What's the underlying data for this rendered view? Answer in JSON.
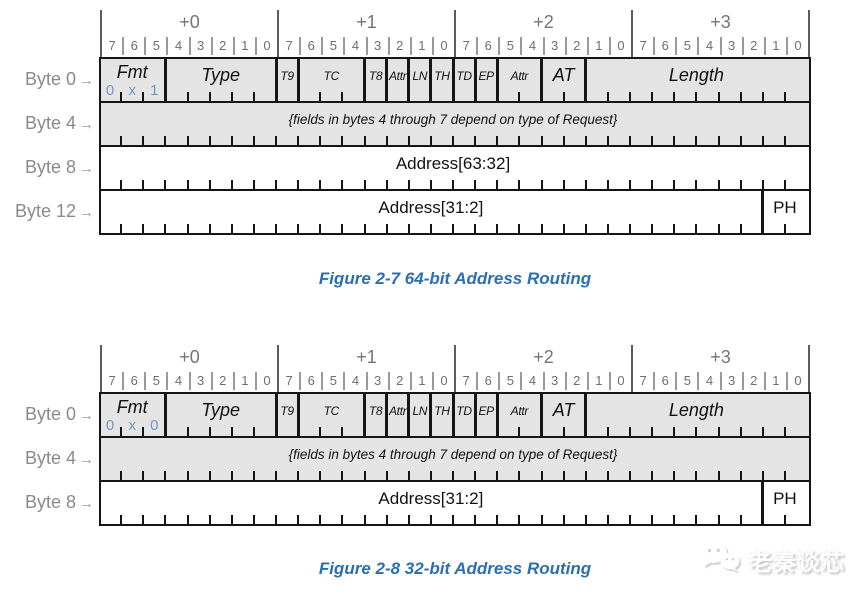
{
  "arrow": "→",
  "offsets": [
    "+0",
    "+1",
    "+2",
    "+3"
  ],
  "bit_numbers": [
    "7",
    "6",
    "5",
    "4",
    "3",
    "2",
    "1",
    "0"
  ],
  "colors": {
    "caption_blue": "#2a6faf",
    "fmt_value_blue": "#7495c6",
    "shaded_row_fill": "#e4e4e4",
    "border_black": "#151515",
    "gray_label": "#8a8a8a"
  },
  "figures": [
    {
      "caption": "Figure 2-7 64-bit Address Routing",
      "rows": [
        {
          "label": "Byte 0",
          "shaded": true,
          "fields": [
            {
              "label": "Fmt",
              "bits": 3,
              "value": "0x1"
            },
            {
              "label": "Type",
              "bits": 5
            },
            {
              "label": "T9",
              "bits": 1
            },
            {
              "label": "TC",
              "bits": 3
            },
            {
              "label": "T8",
              "bits": 1
            },
            {
              "label": "Attr",
              "bits": 1
            },
            {
              "label": "LN",
              "bits": 1
            },
            {
              "label": "TH",
              "bits": 1
            },
            {
              "label": "TD",
              "bits": 1
            },
            {
              "label": "EP",
              "bits": 1
            },
            {
              "label": "Attr",
              "bits": 2
            },
            {
              "label": "AT",
              "bits": 2
            },
            {
              "label": "Length",
              "bits": 10
            }
          ]
        },
        {
          "label": "Byte 4",
          "shaded": true,
          "note": "{fields in bytes 4 through 7 depend on type of Request}",
          "fields": [
            {
              "label": "",
              "bits": 32
            }
          ]
        },
        {
          "label": "Byte 8",
          "shaded": false,
          "fields": [
            {
              "label": "Address[63:32]",
              "bits": 32
            }
          ]
        },
        {
          "label": "Byte 12",
          "shaded": false,
          "fields": [
            {
              "label": "Address[31:2]",
              "bits": 30
            },
            {
              "label": "PH",
              "bits": 2
            }
          ]
        }
      ]
    },
    {
      "caption": "Figure 2-8 32-bit Address Routing",
      "rows": [
        {
          "label": "Byte 0",
          "shaded": true,
          "fields": [
            {
              "label": "Fmt",
              "bits": 3,
              "value": "0x0"
            },
            {
              "label": "Type",
              "bits": 5
            },
            {
              "label": "T9",
              "bits": 1
            },
            {
              "label": "TC",
              "bits": 3
            },
            {
              "label": "T8",
              "bits": 1
            },
            {
              "label": "Attr",
              "bits": 1
            },
            {
              "label": "LN",
              "bits": 1
            },
            {
              "label": "TH",
              "bits": 1
            },
            {
              "label": "TD",
              "bits": 1
            },
            {
              "label": "EP",
              "bits": 1
            },
            {
              "label": "Attr",
              "bits": 2
            },
            {
              "label": "AT",
              "bits": 2
            },
            {
              "label": "Length",
              "bits": 10
            }
          ]
        },
        {
          "label": "Byte 4",
          "shaded": true,
          "note": "{fields in bytes 4 through 7 depend on type of Request}",
          "fields": [
            {
              "label": "",
              "bits": 32
            }
          ]
        },
        {
          "label": "Byte 8",
          "shaded": false,
          "fields": [
            {
              "label": "Address[31:2]",
              "bits": 30
            },
            {
              "label": "PH",
              "bits": 2
            }
          ]
        }
      ]
    }
  ],
  "watermark": {
    "text": "老秦谈芯",
    "icon": "wechat-logo-icon"
  }
}
